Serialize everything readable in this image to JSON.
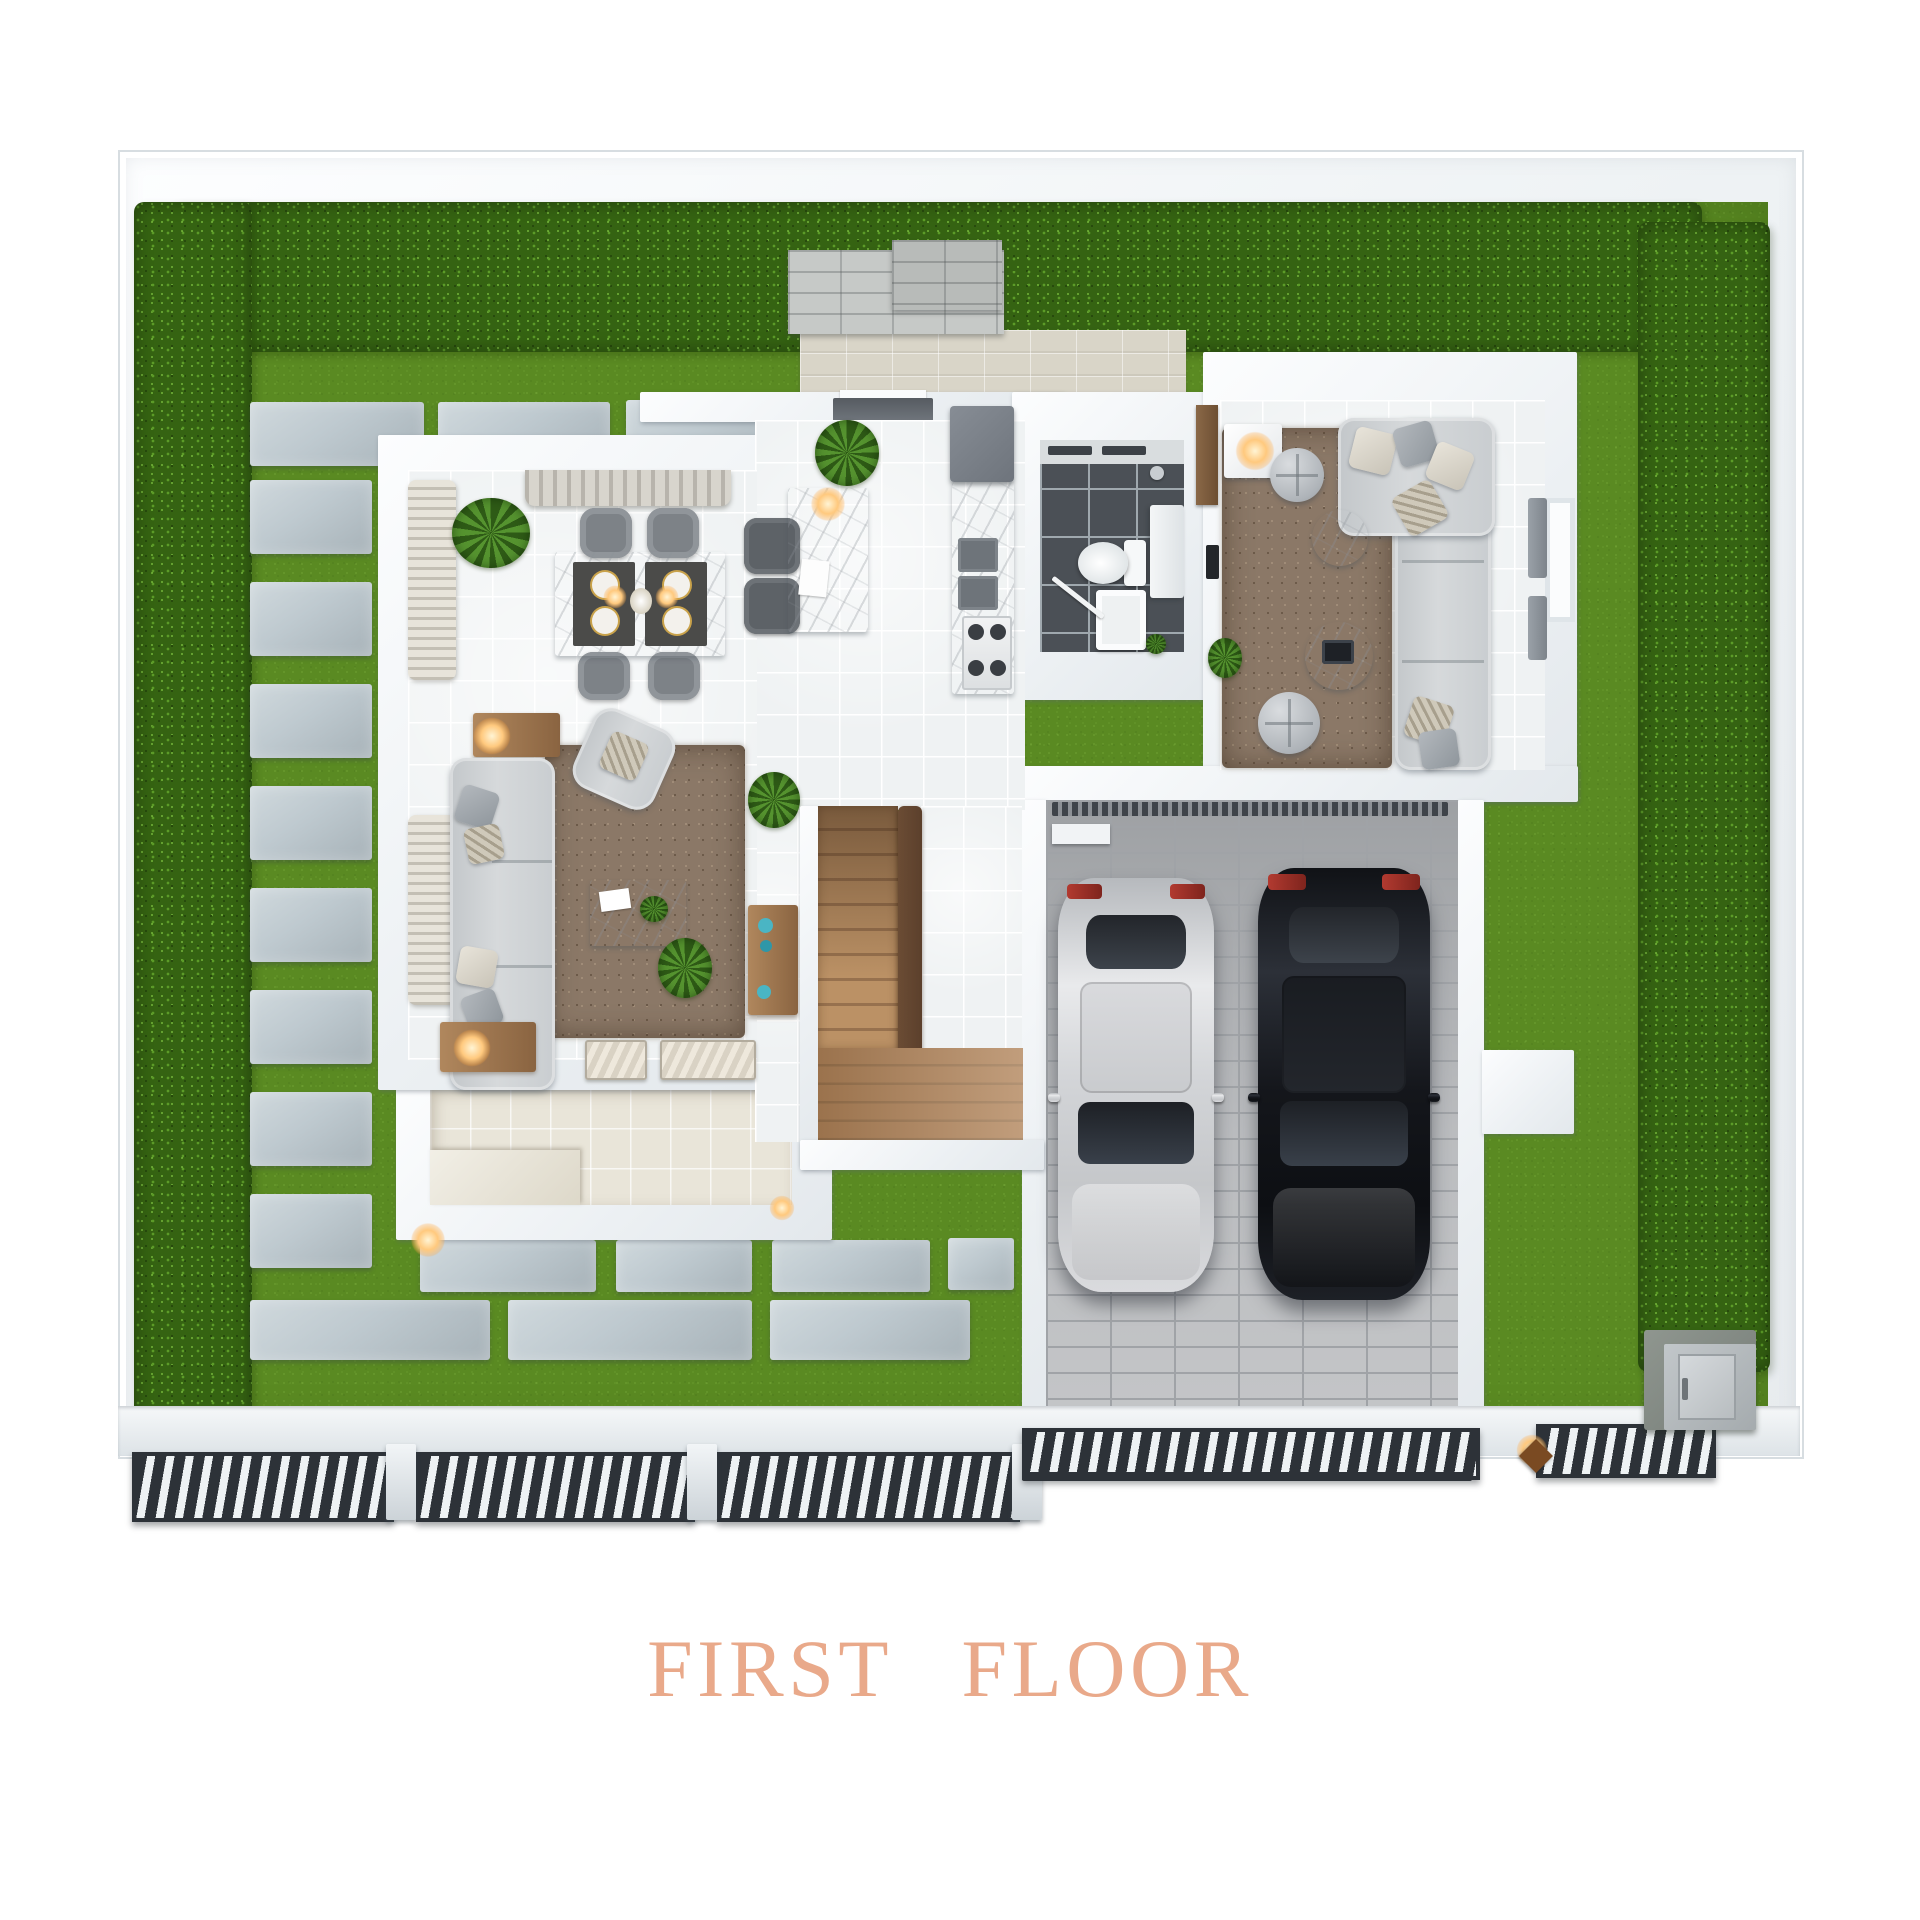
{
  "title": {
    "text": "FIRST FLOOR"
  },
  "palette": {
    "page_bg": "#ffffff",
    "wall": "#f1f4f6",
    "wall_edge": "#d7dde1",
    "grass": "#5a8a22",
    "grass_dark": "#47711a",
    "grass_light": "#74a636",
    "hedge": "#356312",
    "hedge_light": "#5c9c28",
    "paving": "#bec9cf",
    "paving_dark": "#a7b2b8",
    "travertine": "#d9d5c8",
    "tile": "#eff2f3",
    "bath_tile": "#4b5056",
    "rug": "#8b7867",
    "sofa": "#d6d9db",
    "garage_floor": "#b3b5b8",
    "fence_dark": "#2d3238",
    "lamp_glow": "#ffc97e",
    "car_silver": "#d4d5d8",
    "car_black": "#1b1e23",
    "accent_teal": "#4ab5c4",
    "title_color": "#e9a98a"
  },
  "scene": {
    "type": "3d-render-top-view-floor-plan",
    "floor_label": "FIRST FLOOR",
    "exterior": [
      "perimeter-wall",
      "hedge-top",
      "hedge-left",
      "hedge-right",
      "lawn",
      "stepping-stone-path",
      "entry-pavement",
      "garden-stone-wall",
      "front-fence",
      "sliding-gate",
      "gate-lamp",
      "utility-cabinet",
      "patio",
      "wall-sconces"
    ],
    "rooms": [
      {
        "name": "dining-area",
        "furniture": [
          "dining-table",
          "dining-chair x4",
          "gold-place-settings",
          "chandelier",
          "potted-plant",
          "window-valance"
        ]
      },
      {
        "name": "living-room",
        "furniture": [
          "sofa",
          "throw-pillows",
          "area-rug",
          "marble-coffee-table",
          "armchair",
          "side-table-lamp x2",
          "curtains",
          "x-benches",
          "wood-console",
          "blue-vases",
          "plants"
        ]
      },
      {
        "name": "kitchen",
        "furniture": [
          "island-counter",
          "bar-stool x2",
          "pendant-lamp",
          "refrigerator",
          "counter-sink",
          "gas-stove",
          "foyer-plant",
          "entry-mat"
        ]
      },
      {
        "name": "bathroom",
        "furniture": [
          "toilet",
          "shower-tray",
          "vanity",
          "shower-head",
          "dark-floor-tiles"
        ]
      },
      {
        "name": "family-room",
        "furniture": [
          "sectional-sofa",
          "throw-pillows",
          "shag-rug",
          "round-coffee-table x2",
          "pouf x2",
          "console-with-round-lamp",
          "window-curtains",
          "wood-door",
          "plant"
        ]
      },
      {
        "name": "staircase",
        "furniture": [
          "wood-treads",
          "handrail",
          "lower-landing"
        ]
      },
      {
        "name": "garage",
        "furniture": [
          "silver-car",
          "black-car",
          "brick-paving",
          "drain-strip",
          "wall-rack",
          "driveway"
        ]
      }
    ]
  }
}
